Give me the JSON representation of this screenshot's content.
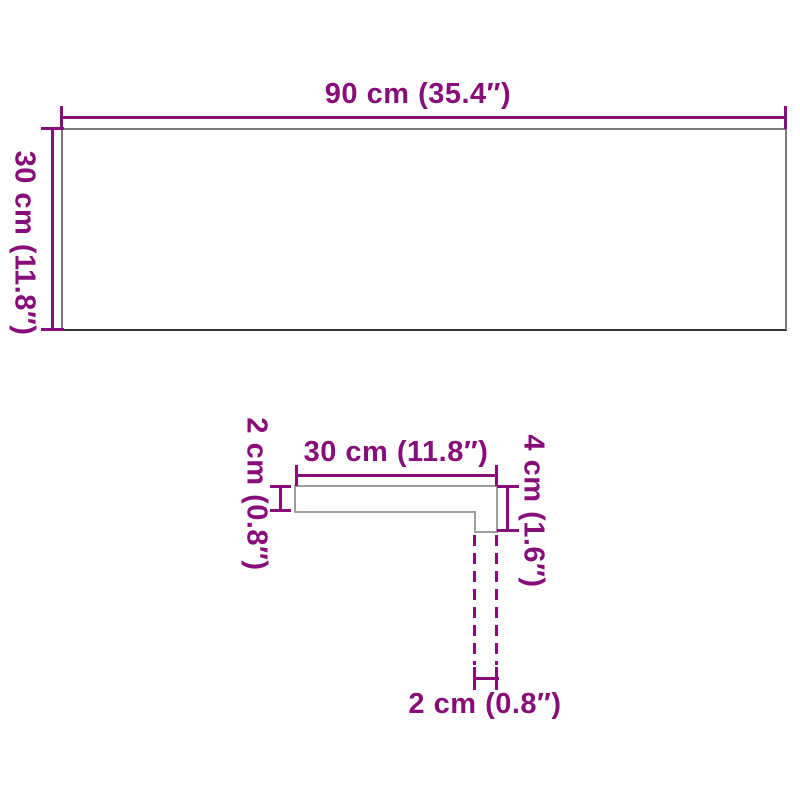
{
  "colors": {
    "dimension": "#870E79",
    "board_outline": "#7B7B7B",
    "board_outline_bottom": "#323232",
    "profile_outline": "#9D9D9D",
    "background": "#FFFFFF"
  },
  "top_view": {
    "width_label": "90 cm (35.4″)",
    "depth_label": "30 cm (11.8″)"
  },
  "profile_view": {
    "width_label": "30 cm (11.8″)",
    "thickness_label": "2 cm (0.8″)",
    "height_label": "4 cm (1.6″)",
    "lip_label": "2 cm (0.8″)"
  }
}
